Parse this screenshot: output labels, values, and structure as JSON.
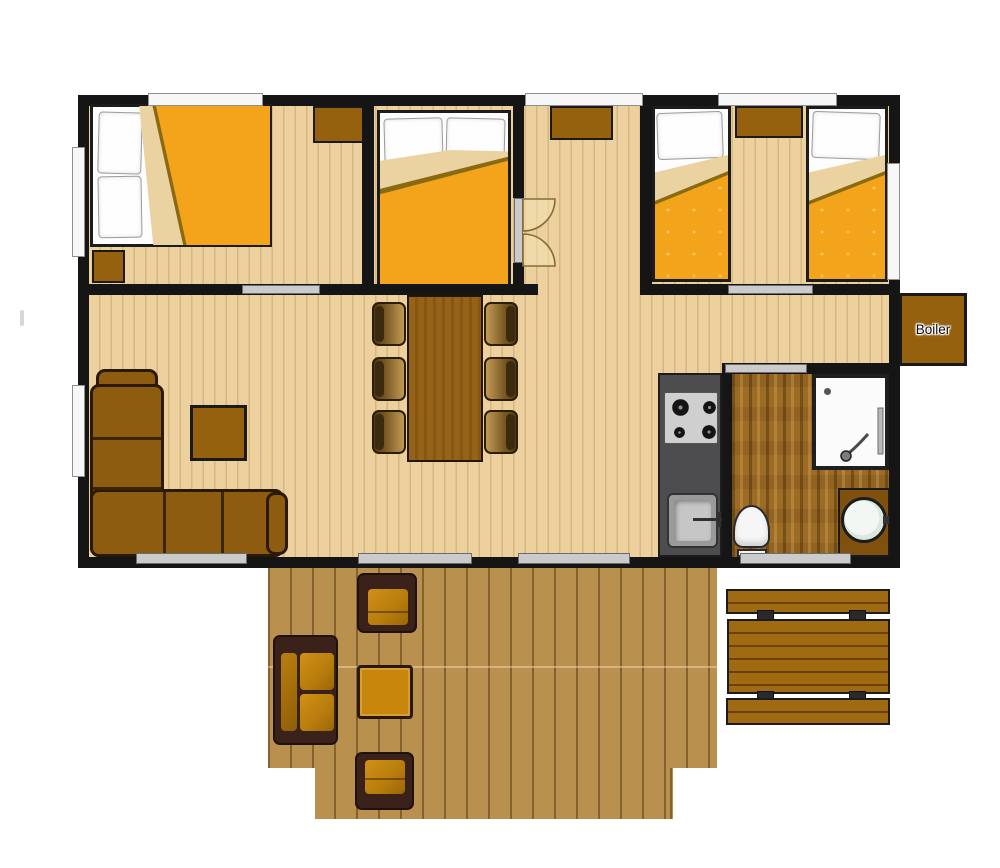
{
  "title": "Chalet / mobile-home floor plan, top-down view with furnished rooms and outdoor deck",
  "labels": {
    "boiler": "Boiler"
  },
  "colors": {
    "wall": "#151515",
    "indoor_floor": "#ecd09e",
    "deck_floor": "#b9904d",
    "bathroom_floor": "#9c6b24",
    "duvet_orange": "#f4a41a",
    "duvet_fold_cream": "#ead3a0",
    "furniture_brown": "#96610e",
    "outdoor_cushion": "#c8860d",
    "kitchen_counter": "#4d4d4f",
    "window_white": "#f7f7f7",
    "sliding_door_gray": "#cbcbcb"
  },
  "rooms": [
    {
      "name": "Double bedroom (left)"
    },
    {
      "name": "Double bedroom (middle)"
    },
    {
      "name": "Hallway"
    },
    {
      "name": "Twin bedroom"
    },
    {
      "name": "Living / dining area"
    },
    {
      "name": "Kitchen"
    },
    {
      "name": "Bathroom"
    },
    {
      "name": "Boiler cupboard"
    },
    {
      "name": "Deck terrace with outdoor lounge and picnic table"
    }
  ],
  "furniture": {
    "double_beds": 2,
    "single_beds": 2,
    "nightstands": 3,
    "wardrobes": 1,
    "dining_table": 1,
    "dining_chairs": 6,
    "corner_sofa": 1,
    "indoor_coffee_table": 1,
    "hob_burners": 4,
    "kitchen_sink": 1,
    "shower": 1,
    "toilet": 1,
    "washbasin": 1,
    "deck_sofa": 1,
    "deck_armchairs": 2,
    "deck_coffee_table": 1,
    "picnic_table": 1,
    "picnic_benches": 2
  }
}
